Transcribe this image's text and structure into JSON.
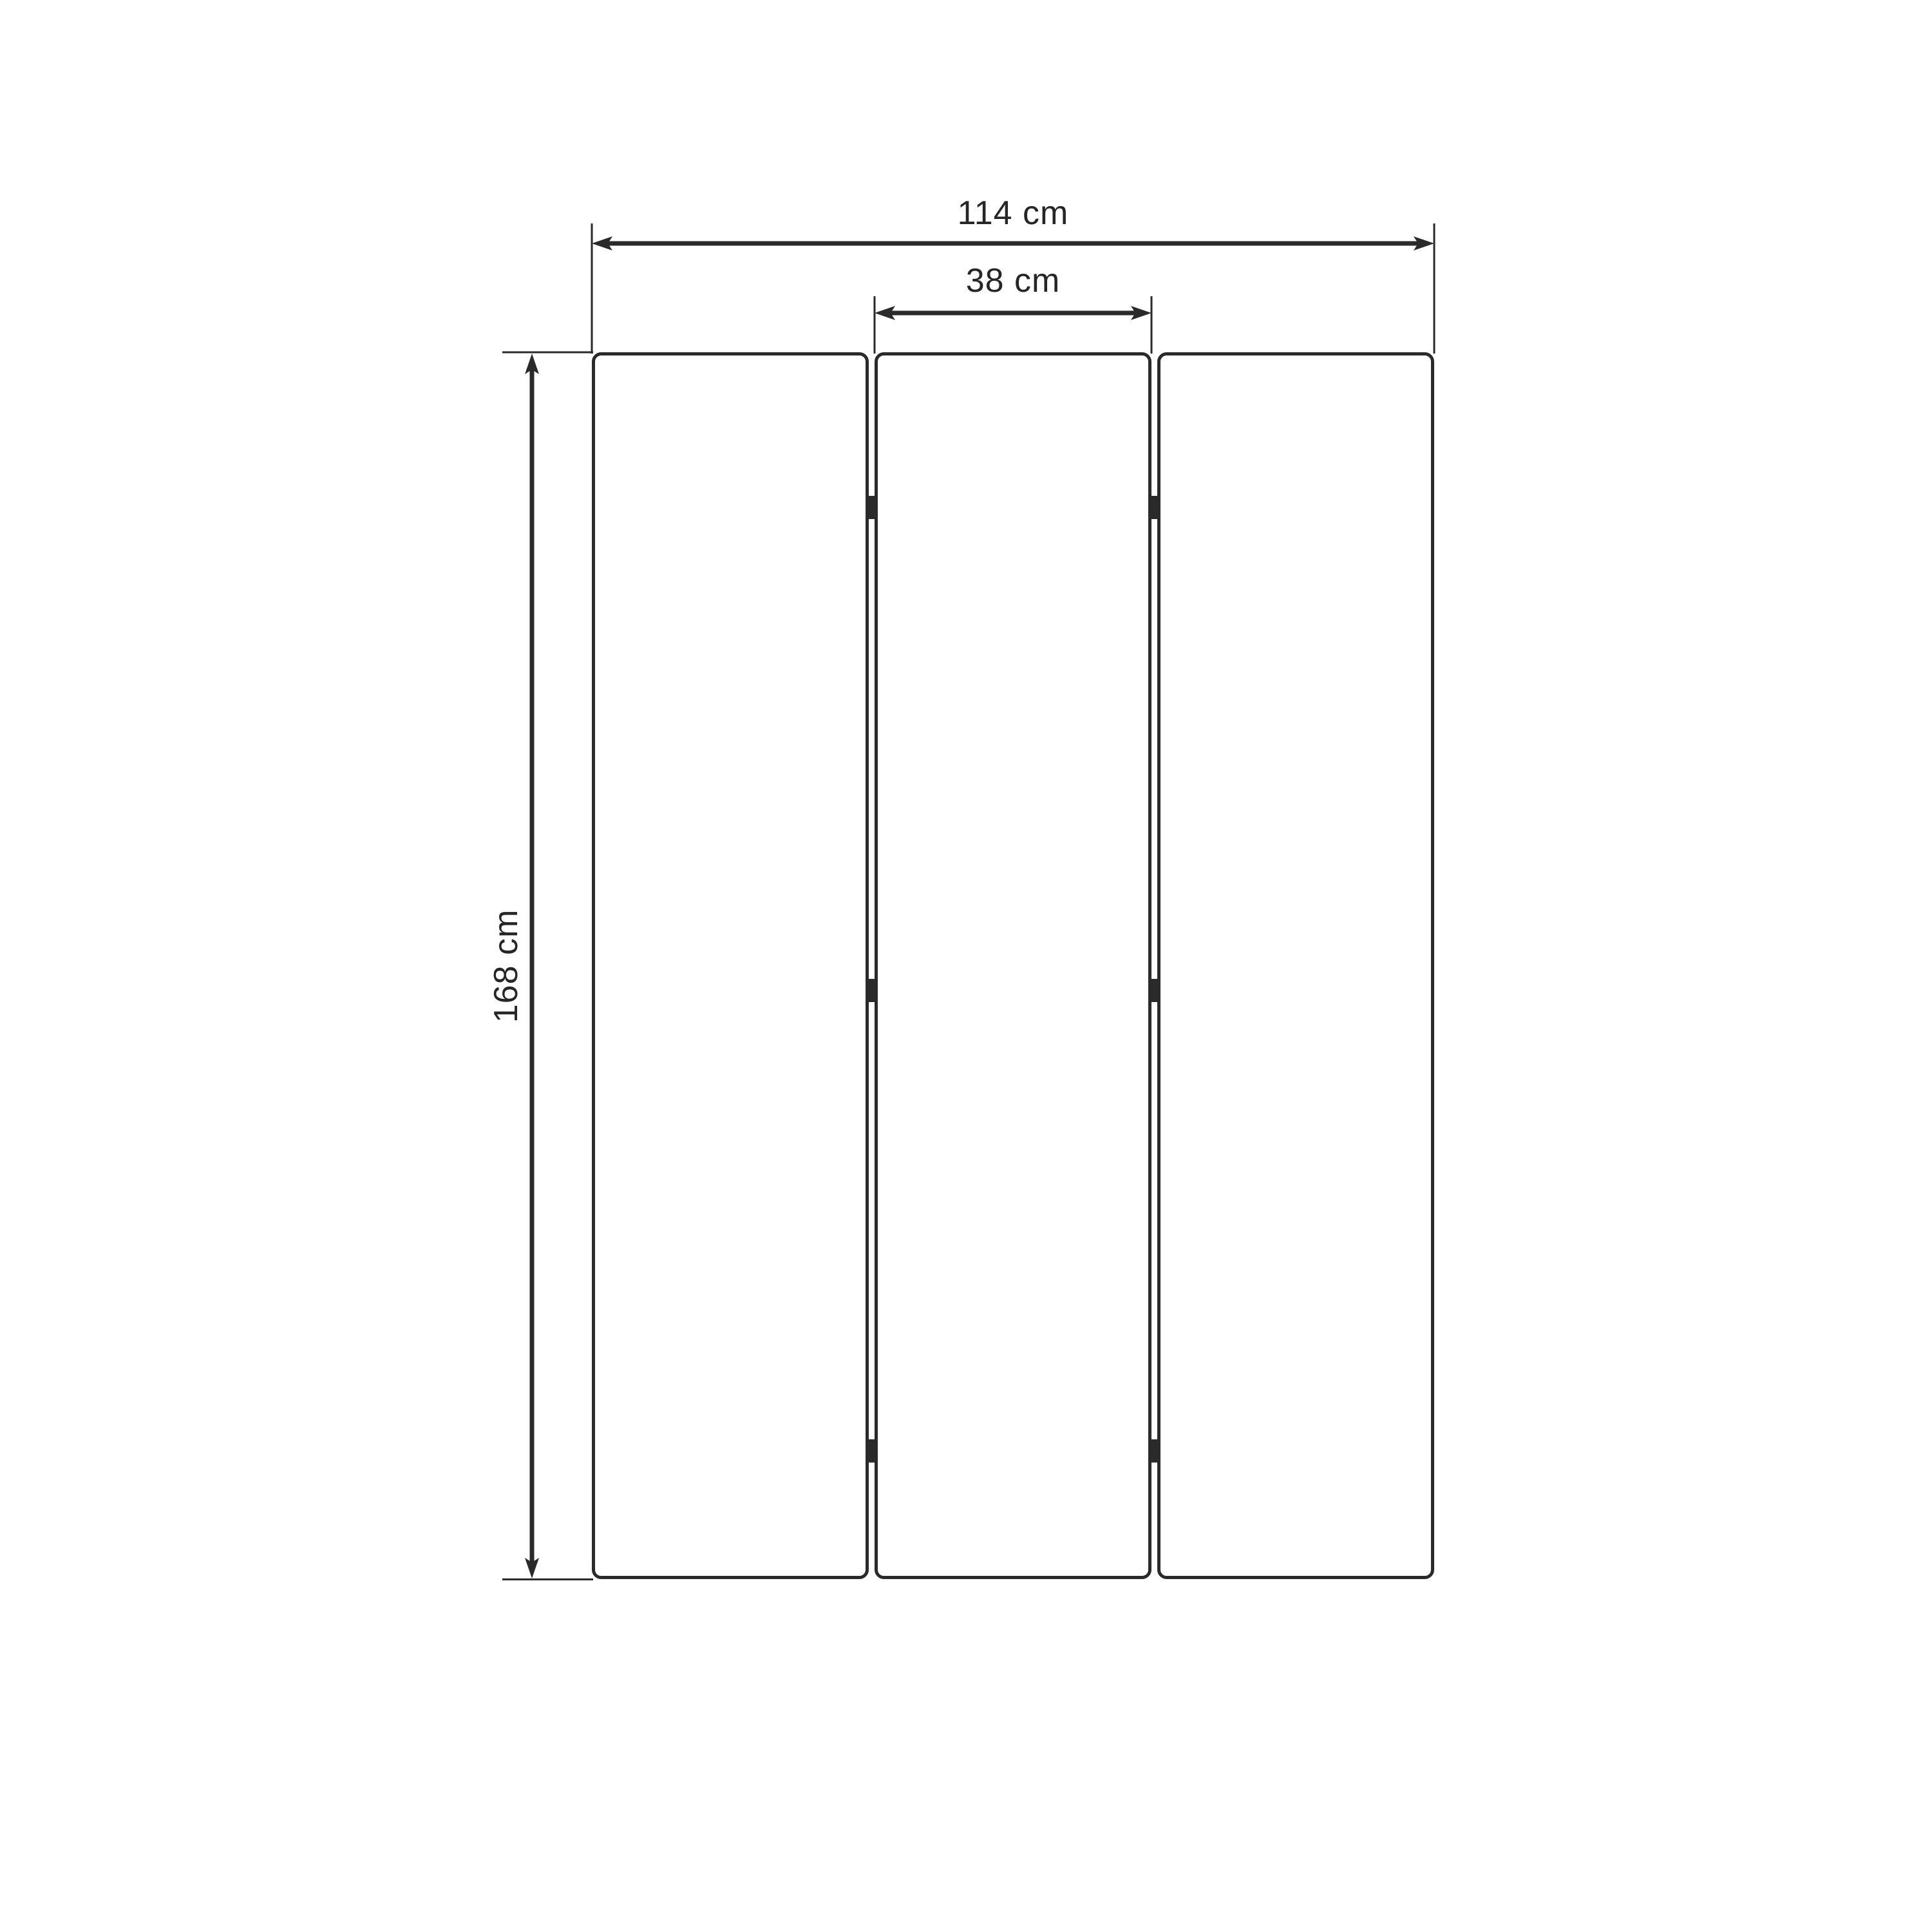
{
  "page": {
    "background_color": "#ffffff"
  },
  "diagram": {
    "type": "furniture-dimension-drawing",
    "subject": "three-panel folding screen, front elevation",
    "line_color": "#2a2a2a",
    "text_color": "#262626",
    "panel_count": 3,
    "hinge_columns": 2,
    "hinge_rows_per_column": 3,
    "dimensions": {
      "total_width": {
        "label": "114 cm",
        "value": 114,
        "unit": "cm"
      },
      "panel_width": {
        "label": "38 cm",
        "value": 38,
        "unit": "cm"
      },
      "height": {
        "label": "168 cm",
        "value": 168,
        "unit": "cm"
      }
    }
  }
}
